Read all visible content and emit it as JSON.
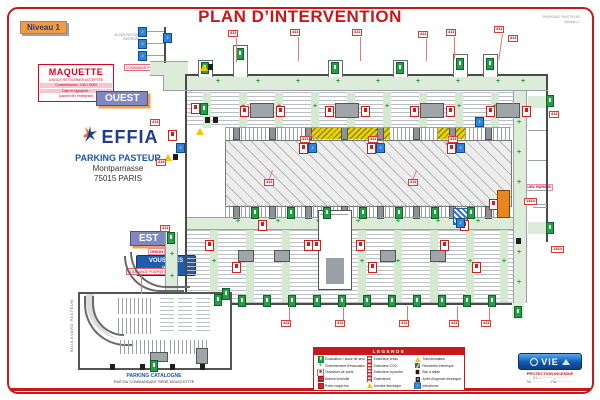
{
  "header": {
    "title": "PLAN D’INTERVENTION",
    "level_badge": "Niveau 1",
    "ref_line1": "PARKING PASTEUR",
    "ref_line2": "Niveau 1"
  },
  "maquette": {
    "title": "MAQUETTE",
    "line1": "A NOUS RETOURNER ACCEPTÉE",
    "line2": "Commentaires : OUI / NON",
    "line3": "Date et signature :",
    "line4": "(cachet de l’entreprise)"
  },
  "direction_labels": {
    "ouest": "OUEST",
    "est": "EST"
  },
  "brand": {
    "name": "EFFIA",
    "site": "PARKING PASTEUR",
    "district": "Montparnasse",
    "city": "75015 PARIS"
  },
  "you_are_here": {
    "tag": "ORION",
    "line1": "VOUS ÊTES",
    "line2": "ICI"
  },
  "commande_pompiers": "COMMANDE POMPIERS",
  "acces_pieton": "ACCES PIETON PASTEUR",
  "accueil_label": "ACCUEIL PARKING",
  "catalogne": {
    "name": "PARKING CATALOGNE",
    "street": "RUE DU COMMANDANT RENÉ MOUCHOTTE",
    "boulevard": "BOULEVARD PASTEUR"
  },
  "legend": {
    "title": "LEGENDE",
    "columns": [
      [
        {
          "icon": "exit",
          "label": "Evacuation / Issue de secours"
        },
        {
          "icon": "plus",
          "label": "Cheminement d'évacuation"
        },
        {
          "icon": "ria",
          "label": "Ouverture de porte"
        },
        {
          "icon": "alarm",
          "label": "Alarme incendie"
        },
        {
          "icon": "alarm",
          "label": "Porte coupe-feu"
        }
      ],
      [
        {
          "icon": "ext",
          "label": "Extincteur à eau"
        },
        {
          "icon": "ext",
          "label": "Extincteur CO2"
        },
        {
          "icon": "ext",
          "label": "Extincteur à poudre"
        },
        {
          "icon": "ext",
          "label": "Extincteurs"
        },
        {
          "icon": "tri",
          "label": "Armoire électrique"
        }
      ],
      [
        {
          "icon": "tri",
          "label": "Transformateur"
        },
        {
          "icon": "elec",
          "label": "Remontée électrique"
        },
        {
          "icon": "blk",
          "label": "Bac à sable"
        },
        {
          "icon": "cut",
          "label": "Arrêt d'urgence électrique"
        },
        {
          "icon": "blue",
          "label": "Interphone"
        }
      ]
    ]
  },
  "vie": {
    "name": "VIE",
    "tagline": "PROTECTION INCENDIE",
    "line2": "Z.I. — ········· — ·········",
    "line3": "Tél. : ·· ·· ·· ·· ··  -  Fax : ·· ·· ·· ·· ··"
  },
  "colors": {
    "accent_red": "#c9181c",
    "exit_green": "#23a046",
    "corridor_green": "#dcecd8",
    "interphone_blue": "#2f86d6",
    "badge_orange": "#f49b42",
    "label_slate": "#7f88c4"
  },
  "plan": {
    "exit_icons": [
      [
        201,
        62
      ],
      [
        236,
        48
      ],
      [
        331,
        62
      ],
      [
        396,
        62
      ],
      [
        456,
        58
      ],
      [
        486,
        58
      ],
      [
        251,
        207
      ],
      [
        287,
        207
      ],
      [
        323,
        207
      ],
      [
        359,
        207
      ],
      [
        395,
        207
      ],
      [
        431,
        207
      ],
      [
        467,
        207
      ],
      [
        238,
        295
      ],
      [
        263,
        295
      ],
      [
        288,
        295
      ],
      [
        313,
        295
      ],
      [
        338,
        295
      ],
      [
        363,
        295
      ],
      [
        388,
        295
      ],
      [
        413,
        295
      ],
      [
        438,
        295
      ],
      [
        463,
        295
      ],
      [
        488,
        295
      ],
      [
        200,
        103
      ],
      [
        546,
        95
      ],
      [
        546,
        222
      ],
      [
        167,
        232
      ],
      [
        214,
        294
      ],
      [
        150,
        360
      ],
      [
        222,
        288
      ],
      [
        514,
        306
      ]
    ],
    "extinguisher_icons": [
      [
        240,
        106
      ],
      [
        276,
        106
      ],
      [
        325,
        106
      ],
      [
        361,
        106
      ],
      [
        410,
        106
      ],
      [
        446,
        106
      ],
      [
        486,
        106
      ],
      [
        522,
        106
      ],
      [
        232,
        262
      ],
      [
        304,
        240
      ],
      [
        368,
        262
      ],
      [
        440,
        240
      ],
      [
        472,
        262
      ],
      [
        205,
        240
      ],
      [
        312,
        240
      ],
      [
        356,
        240
      ],
      [
        258,
        220
      ],
      [
        460,
        220
      ],
      [
        191,
        103
      ],
      [
        168,
        130
      ],
      [
        489,
        199
      ]
    ],
    "interphone_icons": [
      [
        138,
        27
      ],
      [
        138,
        39
      ],
      [
        138,
        51
      ],
      [
        163,
        33
      ],
      [
        176,
        143
      ],
      [
        475,
        117
      ],
      [
        456,
        218
      ]
    ],
    "warning_icons": [
      [
        200,
        64
      ],
      [
        196,
        128
      ],
      [
        164,
        154
      ]
    ],
    "misc_black_icons": [
      [
        208,
        64
      ],
      [
        205,
        117
      ],
      [
        213,
        117
      ],
      [
        173,
        154
      ],
      [
        516,
        238
      ],
      [
        110,
        364
      ],
      [
        140,
        364
      ],
      [
        170,
        364
      ],
      [
        200,
        364
      ]
    ],
    "tags": [
      [
        228,
        30,
        "411"
      ],
      [
        290,
        29,
        "411"
      ],
      [
        352,
        29,
        "411"
      ],
      [
        418,
        31,
        "411"
      ],
      [
        446,
        29,
        "411"
      ],
      [
        494,
        26,
        "411"
      ],
      [
        508,
        35,
        "411"
      ],
      [
        264,
        179,
        "411"
      ],
      [
        408,
        179,
        "411"
      ],
      [
        281,
        320,
        "411"
      ],
      [
        335,
        320,
        "411"
      ],
      [
        399,
        320,
        "411"
      ],
      [
        449,
        320,
        "411"
      ],
      [
        481,
        320,
        "411"
      ],
      [
        549,
        111,
        "411"
      ],
      [
        551,
        246,
        "1414"
      ],
      [
        524,
        198,
        "1414"
      ],
      [
        150,
        119,
        "411"
      ],
      [
        156,
        159,
        "411"
      ],
      [
        160,
        225,
        "411"
      ]
    ],
    "combo_stations": [
      [
        300,
        136,
        "411"
      ],
      [
        368,
        136,
        "411"
      ],
      [
        448,
        136,
        "411"
      ]
    ]
  }
}
